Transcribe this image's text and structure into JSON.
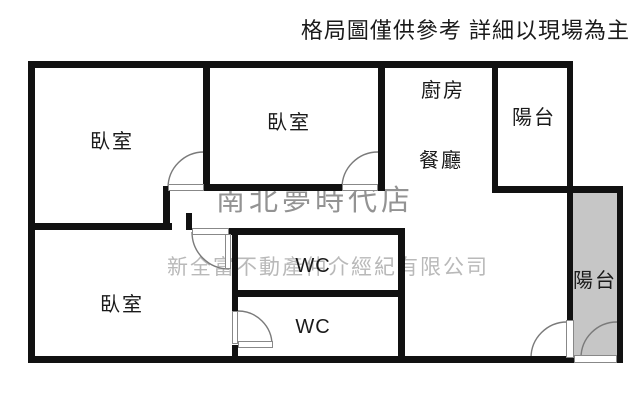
{
  "header": {
    "disclaimer": "格局圖僅供參考 詳細以現場為主"
  },
  "watermarks": {
    "store": "南北夢時代店",
    "company": "新全富不動產仲介經紀有限公司"
  },
  "rooms": {
    "bedroom_top_left": {
      "label": "臥室"
    },
    "bedroom_top_middle": {
      "label": "臥室"
    },
    "bedroom_bottom_left": {
      "label": "臥室"
    },
    "kitchen": {
      "label": "廚房"
    },
    "dining": {
      "label": "餐廳"
    },
    "balcony_top_right": {
      "label": "陽台"
    },
    "balcony_right": {
      "label": "陽台"
    },
    "wc_upper": {
      "label": "WC"
    },
    "wc_lower": {
      "label": "WC"
    }
  },
  "colors": {
    "wall": "#111111",
    "balcony_fill": "#c6c6c6",
    "door_line": "#7a7a7a",
    "watermark_store": "#939393",
    "watermark_company": "#b9b9b9",
    "text": "#1a1a1a"
  }
}
